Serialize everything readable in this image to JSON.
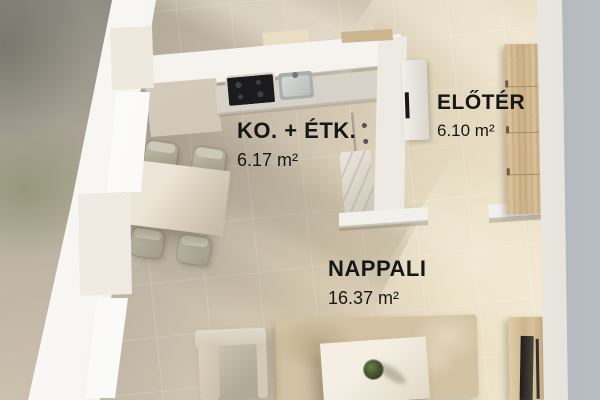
{
  "floorplan": {
    "rooms": [
      {
        "id": "kitchen-dining",
        "name": "KO. + ÉTK.",
        "area": "6.17 m²"
      },
      {
        "id": "hallway",
        "name": "ELŐTÉR",
        "area": "6.10 m²"
      },
      {
        "id": "living-room",
        "name": "NAPPALI",
        "area": "16.37 m²"
      }
    ],
    "furniture": [
      "kitchen-counter",
      "cooktop",
      "sink",
      "built-in-oven-column",
      "marble-column",
      "dining-table",
      "dining-chairs-x4",
      "wardrobe",
      "entry-door",
      "armchair",
      "rug",
      "coffee-table",
      "plant",
      "tv-cabinet"
    ],
    "colors": {
      "floor_shadowed": "#a49c8e",
      "floor_lit": "#efe5cc",
      "wall_white": "#f8f6f2",
      "wood": "#cdb286",
      "appliance_dark": "#1b1b1d",
      "label_text": "#161616",
      "outdoor_right_gray": "#80858b",
      "outdoor_left_olive": "#7a865c"
    }
  }
}
